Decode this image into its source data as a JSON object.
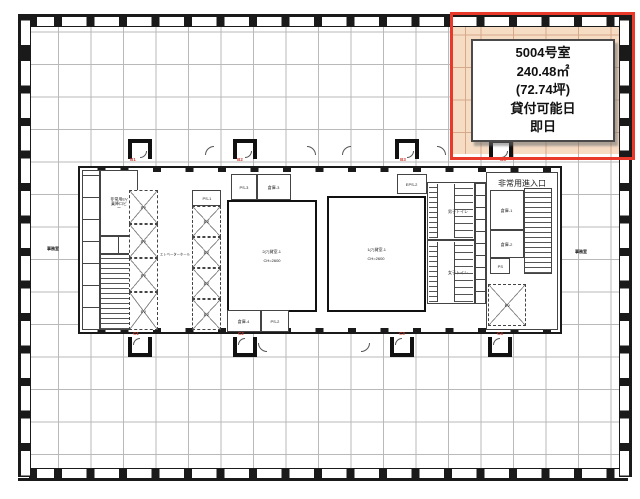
{
  "unit_card": {
    "room_no": "5004号室",
    "area_m2": "240.48㎡",
    "area_tsubo": "(72.74坪)",
    "availability_label": "貸付可能日",
    "availability_value": "即日"
  },
  "colors": {
    "highlight_fill": "#f7dcc4",
    "highlight_border": "#e8392b",
    "wall": "#1a1a1a",
    "grid_line": "#b9b9b9",
    "axis_label_red": "#cf3b2f"
  },
  "core_labels": {
    "elevator_hall": "エレベーターホール",
    "ev": "EV",
    "ps": "PS",
    "ps1": "PS-1",
    "ps2": "PS-2",
    "ps3": "PS-3",
    "eps2": "EPS-2",
    "storage1": "倉庫-1",
    "storage2": "倉庫-2",
    "storage3": "倉庫-3",
    "storage4": "倉庫-4",
    "mens_toilet": "男子トイレ",
    "womens_toilet": "女子トイレ",
    "emergency_lobby": "非常用EV乗降ロビー",
    "emergency_entry": "非常用進入口",
    "room1": "2(7)貸室-1",
    "room1_ch": "CH=2600",
    "room2": "1(7)貸室-1",
    "room2_ch": "CH=2600"
  },
  "axis_labels": {
    "top": [
      "B1",
      "B2",
      "B3",
      "B4"
    ],
    "bottom": [
      "C1",
      "C2",
      "C3",
      "C4"
    ]
  },
  "area_labels": {
    "left": "事務室",
    "right": "事務室"
  }
}
